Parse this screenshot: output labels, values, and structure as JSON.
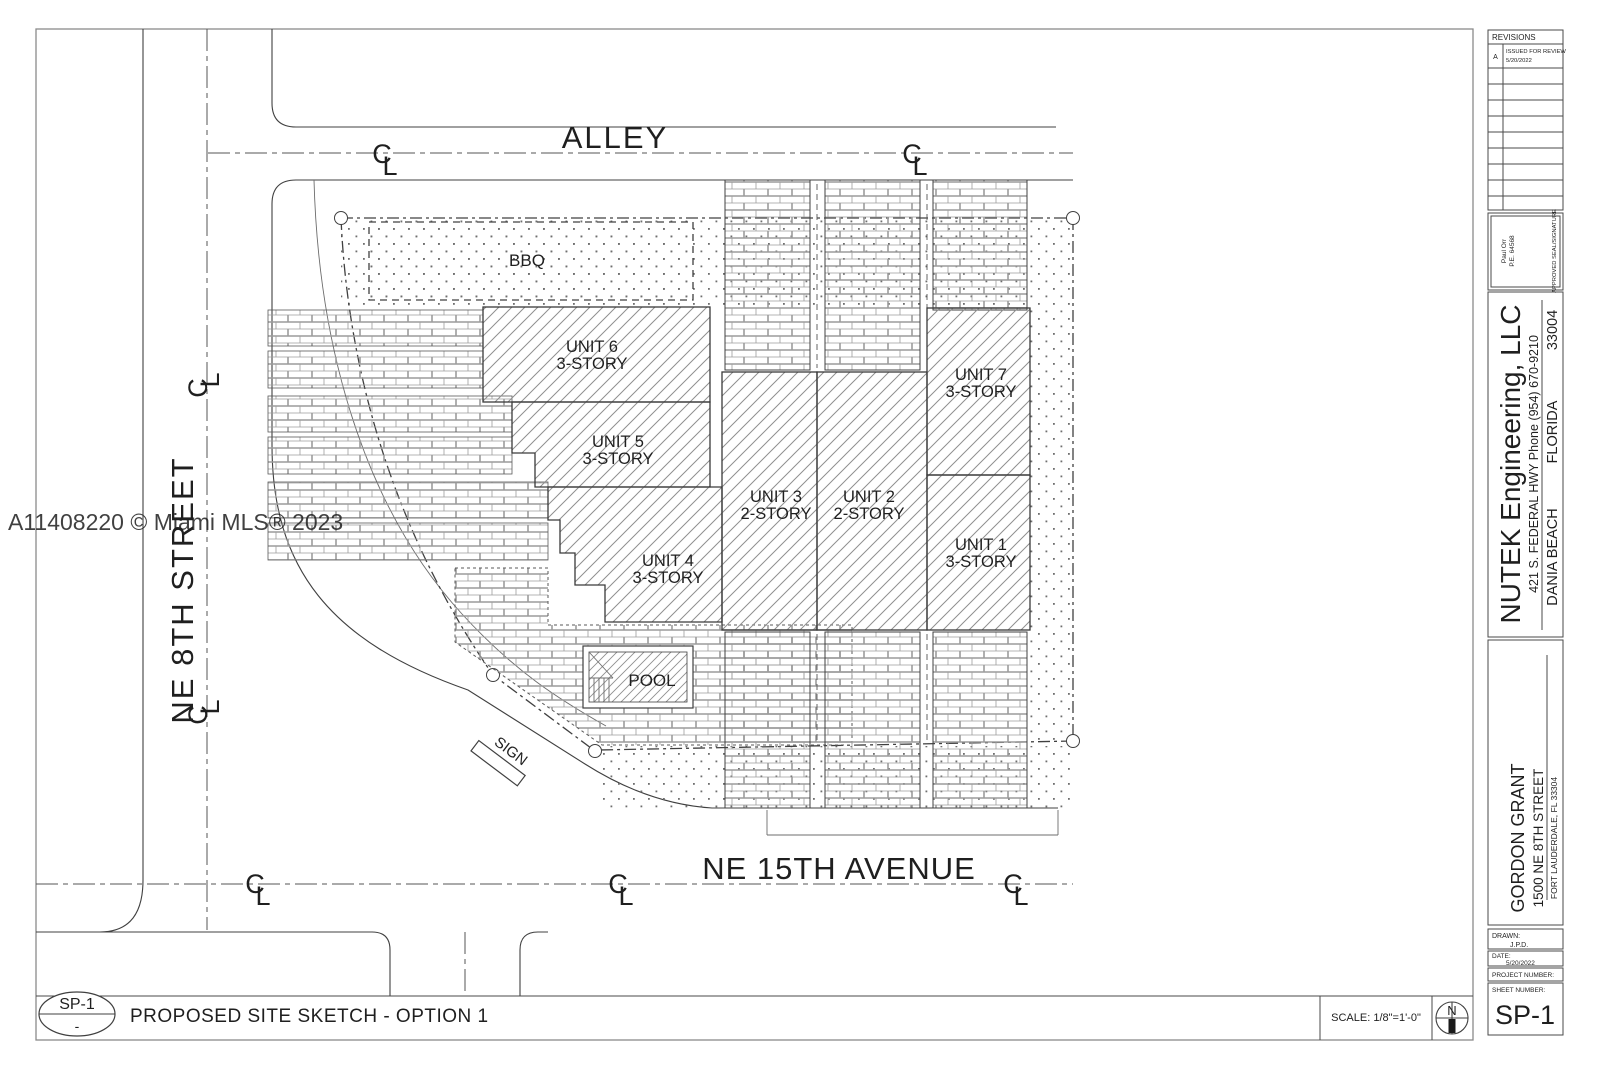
{
  "watermark": "A11408220 © Miami MLS® 2023",
  "streets": {
    "alley": "ALLEY",
    "ne_8th": "NE 8TH STREET",
    "ne_15th": "NE 15TH AVENUE",
    "centerline_c": "C",
    "centerline_l": "L"
  },
  "site": {
    "bbq_label": "BBQ",
    "pool_label": "POOL",
    "sign_label": "SIGN",
    "units": {
      "unit1": {
        "name": "UNIT 1",
        "stories": "3-STORY"
      },
      "unit2": {
        "name": "UNIT 2",
        "stories": "2-STORY"
      },
      "unit3": {
        "name": "UNIT 3",
        "stories": "2-STORY"
      },
      "unit4": {
        "name": "UNIT 4",
        "stories": "3-STORY"
      },
      "unit5": {
        "name": "UNIT 5",
        "stories": "3-STORY"
      },
      "unit6": {
        "name": "UNIT 6",
        "stories": "3-STORY"
      },
      "unit7": {
        "name": "UNIT 7",
        "stories": "3-STORY"
      }
    }
  },
  "title_bar": {
    "sheet_ref": "SP-1",
    "sheet_ref_detail": "-",
    "title": "PROPOSED SITE SKETCH - OPTION 1",
    "scale": "SCALE: 1/8\"=1'-0\"",
    "north_label": "N"
  },
  "title_block": {
    "revisions": {
      "header": "REVISIONS",
      "rev_letter": "A",
      "rev_desc": "ISSUED FOR REVIEW",
      "rev_date": "5/20/2022"
    },
    "seal": {
      "name_line1": "Paul Orr",
      "name_line2": "P.E. 64568",
      "caption": "APPROVED SEAL/SIGNATURE"
    },
    "firm": {
      "name": "NUTEK Engineering, LLC",
      "address": "421 S. FEDERAL HWY Phone (954) 670-9210",
      "city": "DANIA BEACH",
      "state": "FLORIDA",
      "zip": "33004"
    },
    "project": {
      "client": "GORDON GRANT",
      "address": "1500 NE 8TH STREET",
      "city": "FORT LAUDERDALE, FL 33304"
    },
    "stamp": {
      "drawn_label": "DRAWN:",
      "drawn_value": "J.P.D.",
      "date_label": "DATE:",
      "date_value": "5/20/2022",
      "project_number_label": "PROJECT NUMBER:",
      "sheet_number_label": "SHEET NUMBER:",
      "sheet_number_value": "SP-1"
    }
  }
}
